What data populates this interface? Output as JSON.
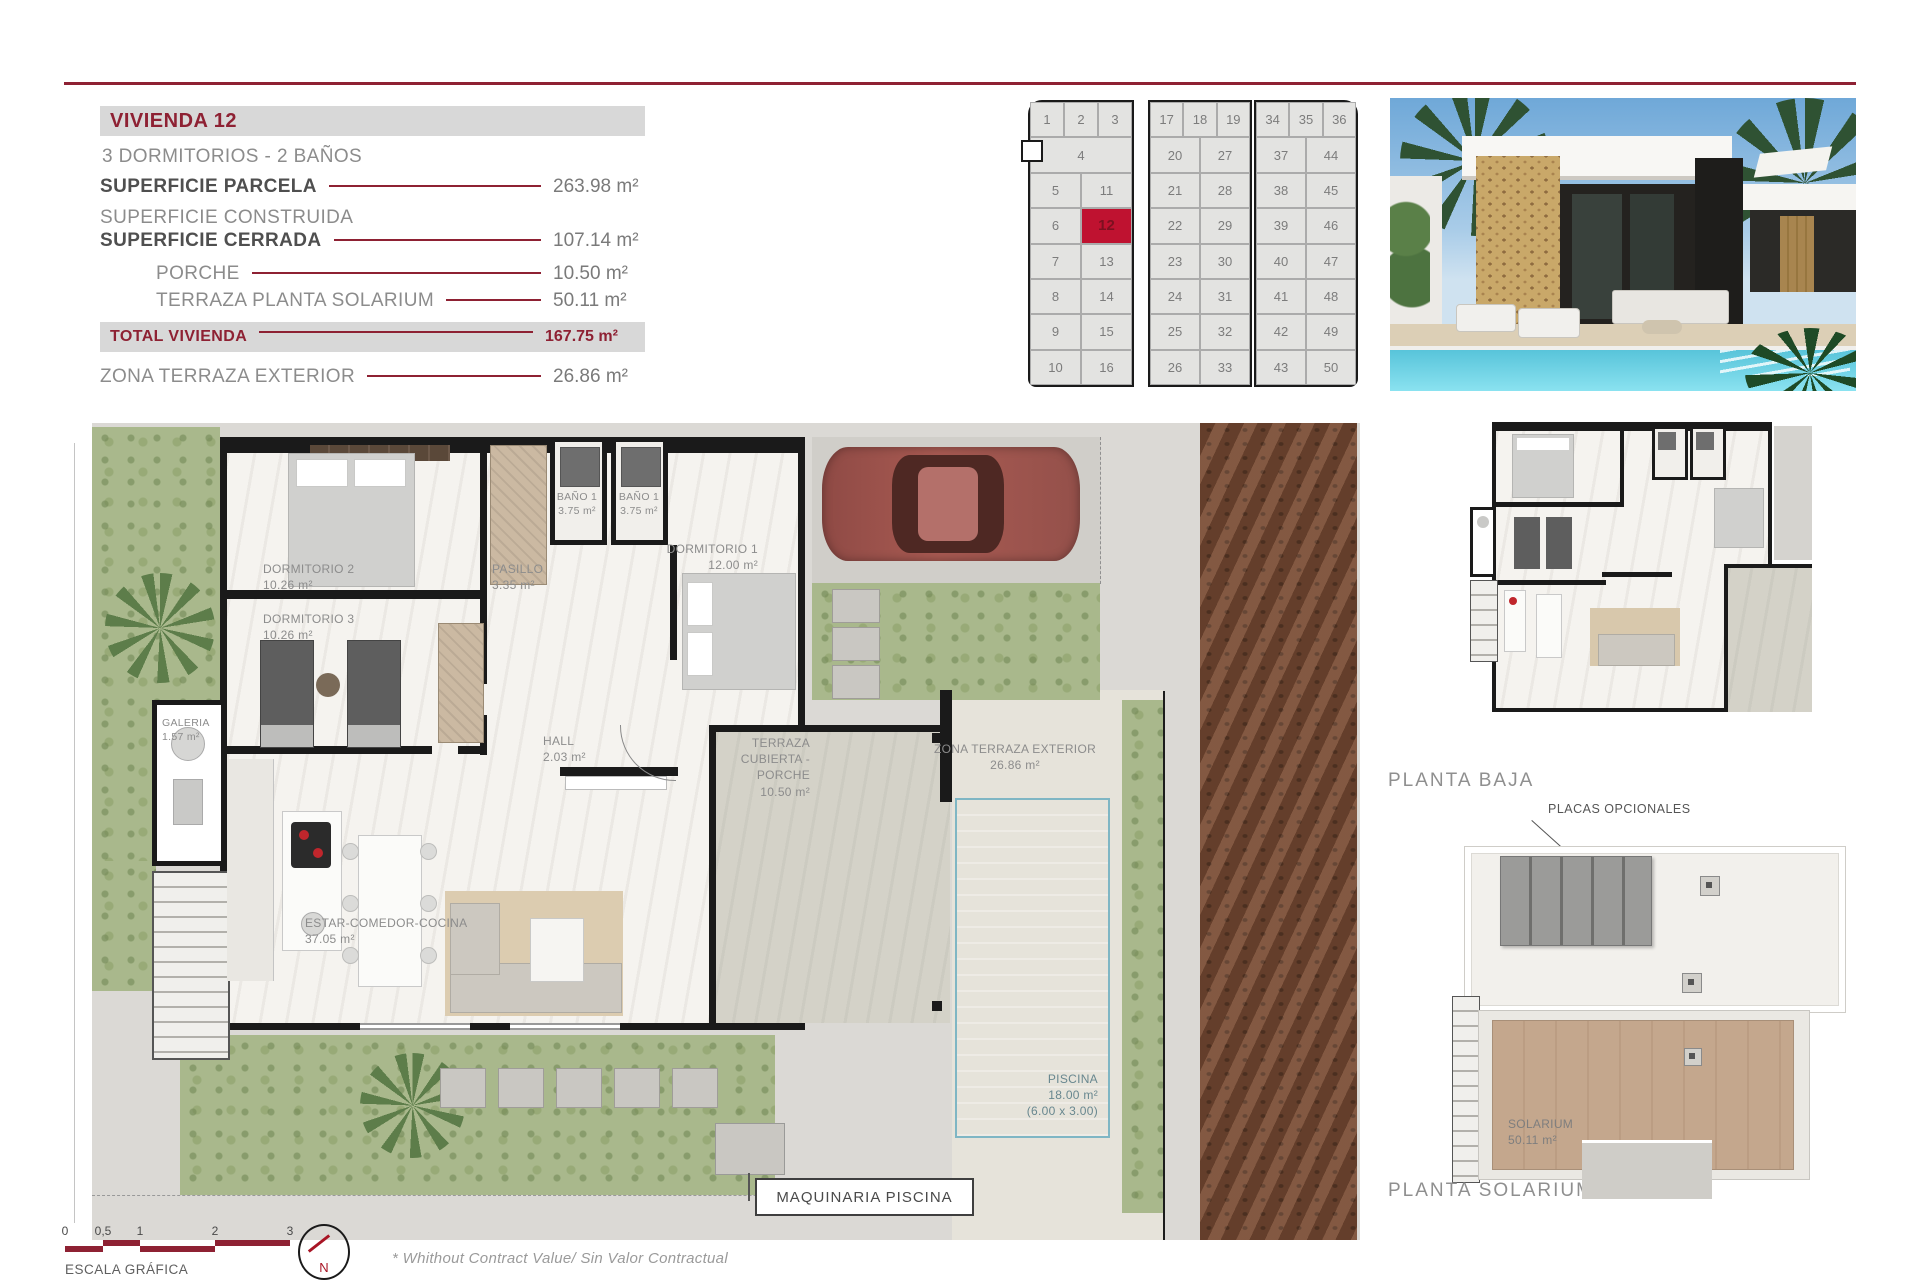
{
  "colors": {
    "accent": "#8e2133",
    "plot_highlight": "#bf1230",
    "header_bar": "#d8d8d8",
    "pool_water": "#8fd9e9",
    "garden_green": "#a9b88c",
    "wall_black": "#1a1a1a",
    "rust_path": "#7a4c34"
  },
  "specs": {
    "title": "VIVIENDA 12",
    "subtitle": "3 DORMITORIOS - 2 BAÑOS",
    "construida_label": "SUPERFICIE CONSTRUIDA",
    "rows": [
      {
        "label": "SUPERFICIE PARCELA",
        "value": "263.98 m²"
      },
      {
        "label": "SUPERFICIE CERRADA",
        "value": "107.14 m²"
      },
      {
        "label": "PORCHE",
        "value": "10.50 m²"
      },
      {
        "label": "TERRAZA PLANTA SOLARIUM",
        "value": "50.11 m²"
      }
    ],
    "total": {
      "label": "TOTAL VIVIENDA",
      "value": "167.75 m²"
    },
    "exterior": {
      "label": "ZONA TERRAZA EXTERIOR",
      "value": "26.86 m²"
    }
  },
  "site_grid": {
    "highlight_plot": "12",
    "blocks": [
      {
        "top_row": [
          "1",
          "2",
          "3"
        ],
        "rows": [
          [
            "4"
          ],
          [
            "5",
            "11"
          ],
          [
            "6",
            "12"
          ],
          [
            "7",
            "13"
          ],
          [
            "8",
            "14"
          ],
          [
            "9",
            "15"
          ],
          [
            "10",
            "16"
          ]
        ]
      },
      {
        "top_row": [
          "17",
          "18",
          "19"
        ],
        "rows": [
          [
            "20",
            "27"
          ],
          [
            "21",
            "28"
          ],
          [
            "22",
            "29"
          ],
          [
            "23",
            "30"
          ],
          [
            "24",
            "31"
          ],
          [
            "25",
            "32"
          ],
          [
            "26",
            "33"
          ]
        ]
      },
      {
        "top_row": [
          "34",
          "35",
          "36"
        ],
        "rows": [
          [
            "37",
            "44"
          ],
          [
            "38",
            "45"
          ],
          [
            "39",
            "46"
          ],
          [
            "40",
            "47"
          ],
          [
            "41",
            "48"
          ],
          [
            "42",
            "49"
          ],
          [
            "43",
            "50"
          ]
        ]
      }
    ]
  },
  "floor_plan": {
    "rooms": [
      {
        "name": "DORMITORIO 2",
        "area": "10.26 m²"
      },
      {
        "name": "DORMITORIO 3",
        "area": "10.26 m²"
      },
      {
        "name": "PASILLO",
        "area": "3.35 m²"
      },
      {
        "name": "BAÑO 1",
        "area": "3.75 m²"
      },
      {
        "name": "BAÑO 1",
        "area": "3.75 m²"
      },
      {
        "name": "DORMITORIO 1",
        "area": "12.00 m²"
      },
      {
        "name": "GALERIA",
        "area": "1.57 m²"
      },
      {
        "name": "HALL",
        "area": "2.03 m²"
      },
      {
        "name": "ESTAR-COMEDOR-COCINA",
        "area": "37.05 m²"
      },
      {
        "name": "TERRAZA CUBIERTA -PORCHE",
        "area": "10.50 m²"
      },
      {
        "name": "ZONA TERRAZA EXTERIOR",
        "area": "26.86 m²"
      }
    ],
    "pool": {
      "name": "PISCINA",
      "area": "18.00 m²",
      "dims": "(6.00 x 3.00)"
    },
    "machine_label": "MAQUINARIA PISCINA"
  },
  "mini_plans": {
    "planta_baja": "PLANTA BAJA",
    "placas": "PLACAS OPCIONALES",
    "solarium": {
      "name": "SOLARIUM",
      "area": "50.11 m²"
    },
    "planta_solarium": "PLANTA SOLARIUM"
  },
  "footer": {
    "scale_ticks": [
      "0",
      "0,5",
      "1",
      "2",
      "3"
    ],
    "scale_label": "ESCALA GRÁFICA",
    "north": "N",
    "disclaimer": "* Whithout Contract Value/ Sin Valor Contractual"
  }
}
